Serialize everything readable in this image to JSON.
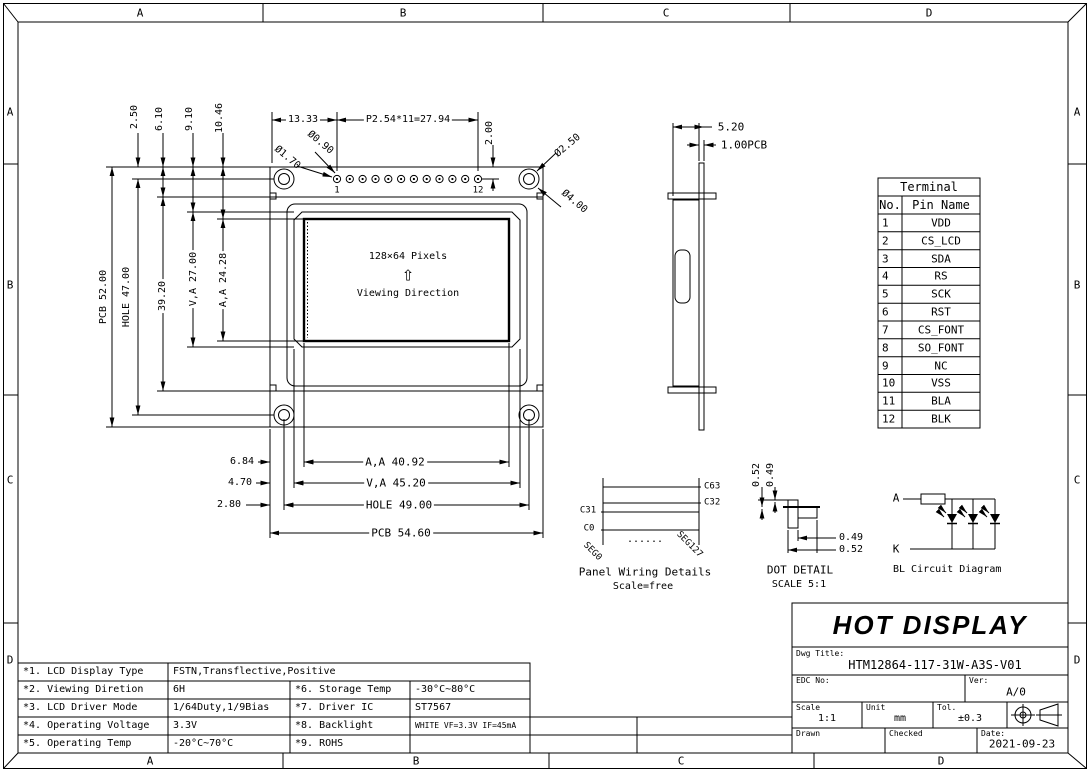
{
  "frame": {
    "top": [
      "A",
      "B",
      "C",
      "D"
    ],
    "bottom": [
      "A",
      "B",
      "C",
      "D"
    ],
    "left": [
      "A",
      "B",
      "C",
      "D"
    ],
    "right": [
      "A",
      "B",
      "C",
      "D"
    ]
  },
  "front": {
    "pixels": "128×64 Pixels",
    "arrow": "⇧",
    "viewing": "Viewing Direction",
    "pin1": "1",
    "pin12": "12",
    "dim_250": "2.50",
    "dim_610": "6.10",
    "dim_910": "9.10",
    "dim_1046": "10.46",
    "dim_1333": "13.33",
    "dim_pitch": "P2.54*11=27.94",
    "dim_200": "2.00",
    "dia_090": "Ø0.90",
    "dia_170": "Ø1.70",
    "dia_250": "Ø2.50",
    "dia_400": "Ø4.00",
    "dim_pcb_h": "PCB 52.00",
    "dim_hole_h": "HOLE 47.00",
    "dim_3920": "39.20",
    "dim_va_h": "V,A 27.00",
    "dim_aa_h": "A,A 24.28",
    "dim_684": "6.84",
    "dim_470": "4.70",
    "dim_280": "2.80",
    "dim_aa_w": "A,A 40.92",
    "dim_va_w": "V,A 45.20",
    "dim_hole_w": "HOLE 49.00",
    "dim_pcb_w": "PCB 54.60"
  },
  "side": {
    "dim_520": "5.20",
    "dim_pcb": "1.00PCB"
  },
  "terminal": {
    "title": "Terminal",
    "h_no": "No.",
    "h_name": "Pin Name",
    "rows": [
      {
        "no": "1",
        "name": "VDD"
      },
      {
        "no": "2",
        "name": "CS_LCD"
      },
      {
        "no": "3",
        "name": "SDA"
      },
      {
        "no": "4",
        "name": "RS"
      },
      {
        "no": "5",
        "name": "SCK"
      },
      {
        "no": "6",
        "name": "RST"
      },
      {
        "no": "7",
        "name": "CS_FONT"
      },
      {
        "no": "8",
        "name": "SO_FONT"
      },
      {
        "no": "9",
        "name": "NC"
      },
      {
        "no": "10",
        "name": "VSS"
      },
      {
        "no": "11",
        "name": "BLA"
      },
      {
        "no": "12",
        "name": "BLK"
      }
    ]
  },
  "wiring": {
    "c63": "C63",
    "c32": "C32",
    "c31": "C31",
    "c0": "C0",
    "seg0": "SEG0",
    "seg127": "SEG127",
    "dots": "......",
    "title": "Panel Wiring Details",
    "scale": "Scale=free"
  },
  "dot": {
    "d052a": "0.52",
    "d049a": "0.49",
    "d049b": "0.49",
    "d052b": "0.52",
    "title": "DOT DETAIL",
    "scale": "SCALE 5:1"
  },
  "bl": {
    "a": "A",
    "k": "K",
    "title": "BL Circuit Diagram"
  },
  "titleblock": {
    "company": "HOT DISPLAY",
    "dwg_label": "Dwg Title:",
    "dwg": "HTM12864-117-31W-A3S-V01",
    "edc_label": "EDC No:",
    "ver_label": "Ver:",
    "ver": "A/0",
    "scale_label": "Scale",
    "scale": "1:1",
    "unit_label": "Unit",
    "unit": "mm",
    "tol_label": "Tol.",
    "tol": "±0.3",
    "drawn_label": "Drawn",
    "checked_label": "Checked",
    "date_label": "Date:",
    "date": "2021-09-23"
  },
  "spec": {
    "rows": [
      {
        "k": "*1. LCD Display Type",
        "v": "FSTN,Transflective,Positive"
      },
      {
        "k": "*2. Viewing Diretion",
        "v": "6H",
        "k2": "*6. Storage Temp",
        "v2": "-30°C~80°C"
      },
      {
        "k": "*3. LCD Driver Mode",
        "v": "1/64Duty,1/9Bias",
        "k2": "*7. Driver IC",
        "v2": "ST7567"
      },
      {
        "k": "*4. Operating Voltage",
        "v": "3.3V",
        "k2": "*8. Backlight",
        "v2": "WHITE VF=3.3V IF=45mA"
      },
      {
        "k": "*5. Operating Temp",
        "v": "-20°C~70°C",
        "k2": "*9. ROHS",
        "v2": ""
      }
    ]
  }
}
